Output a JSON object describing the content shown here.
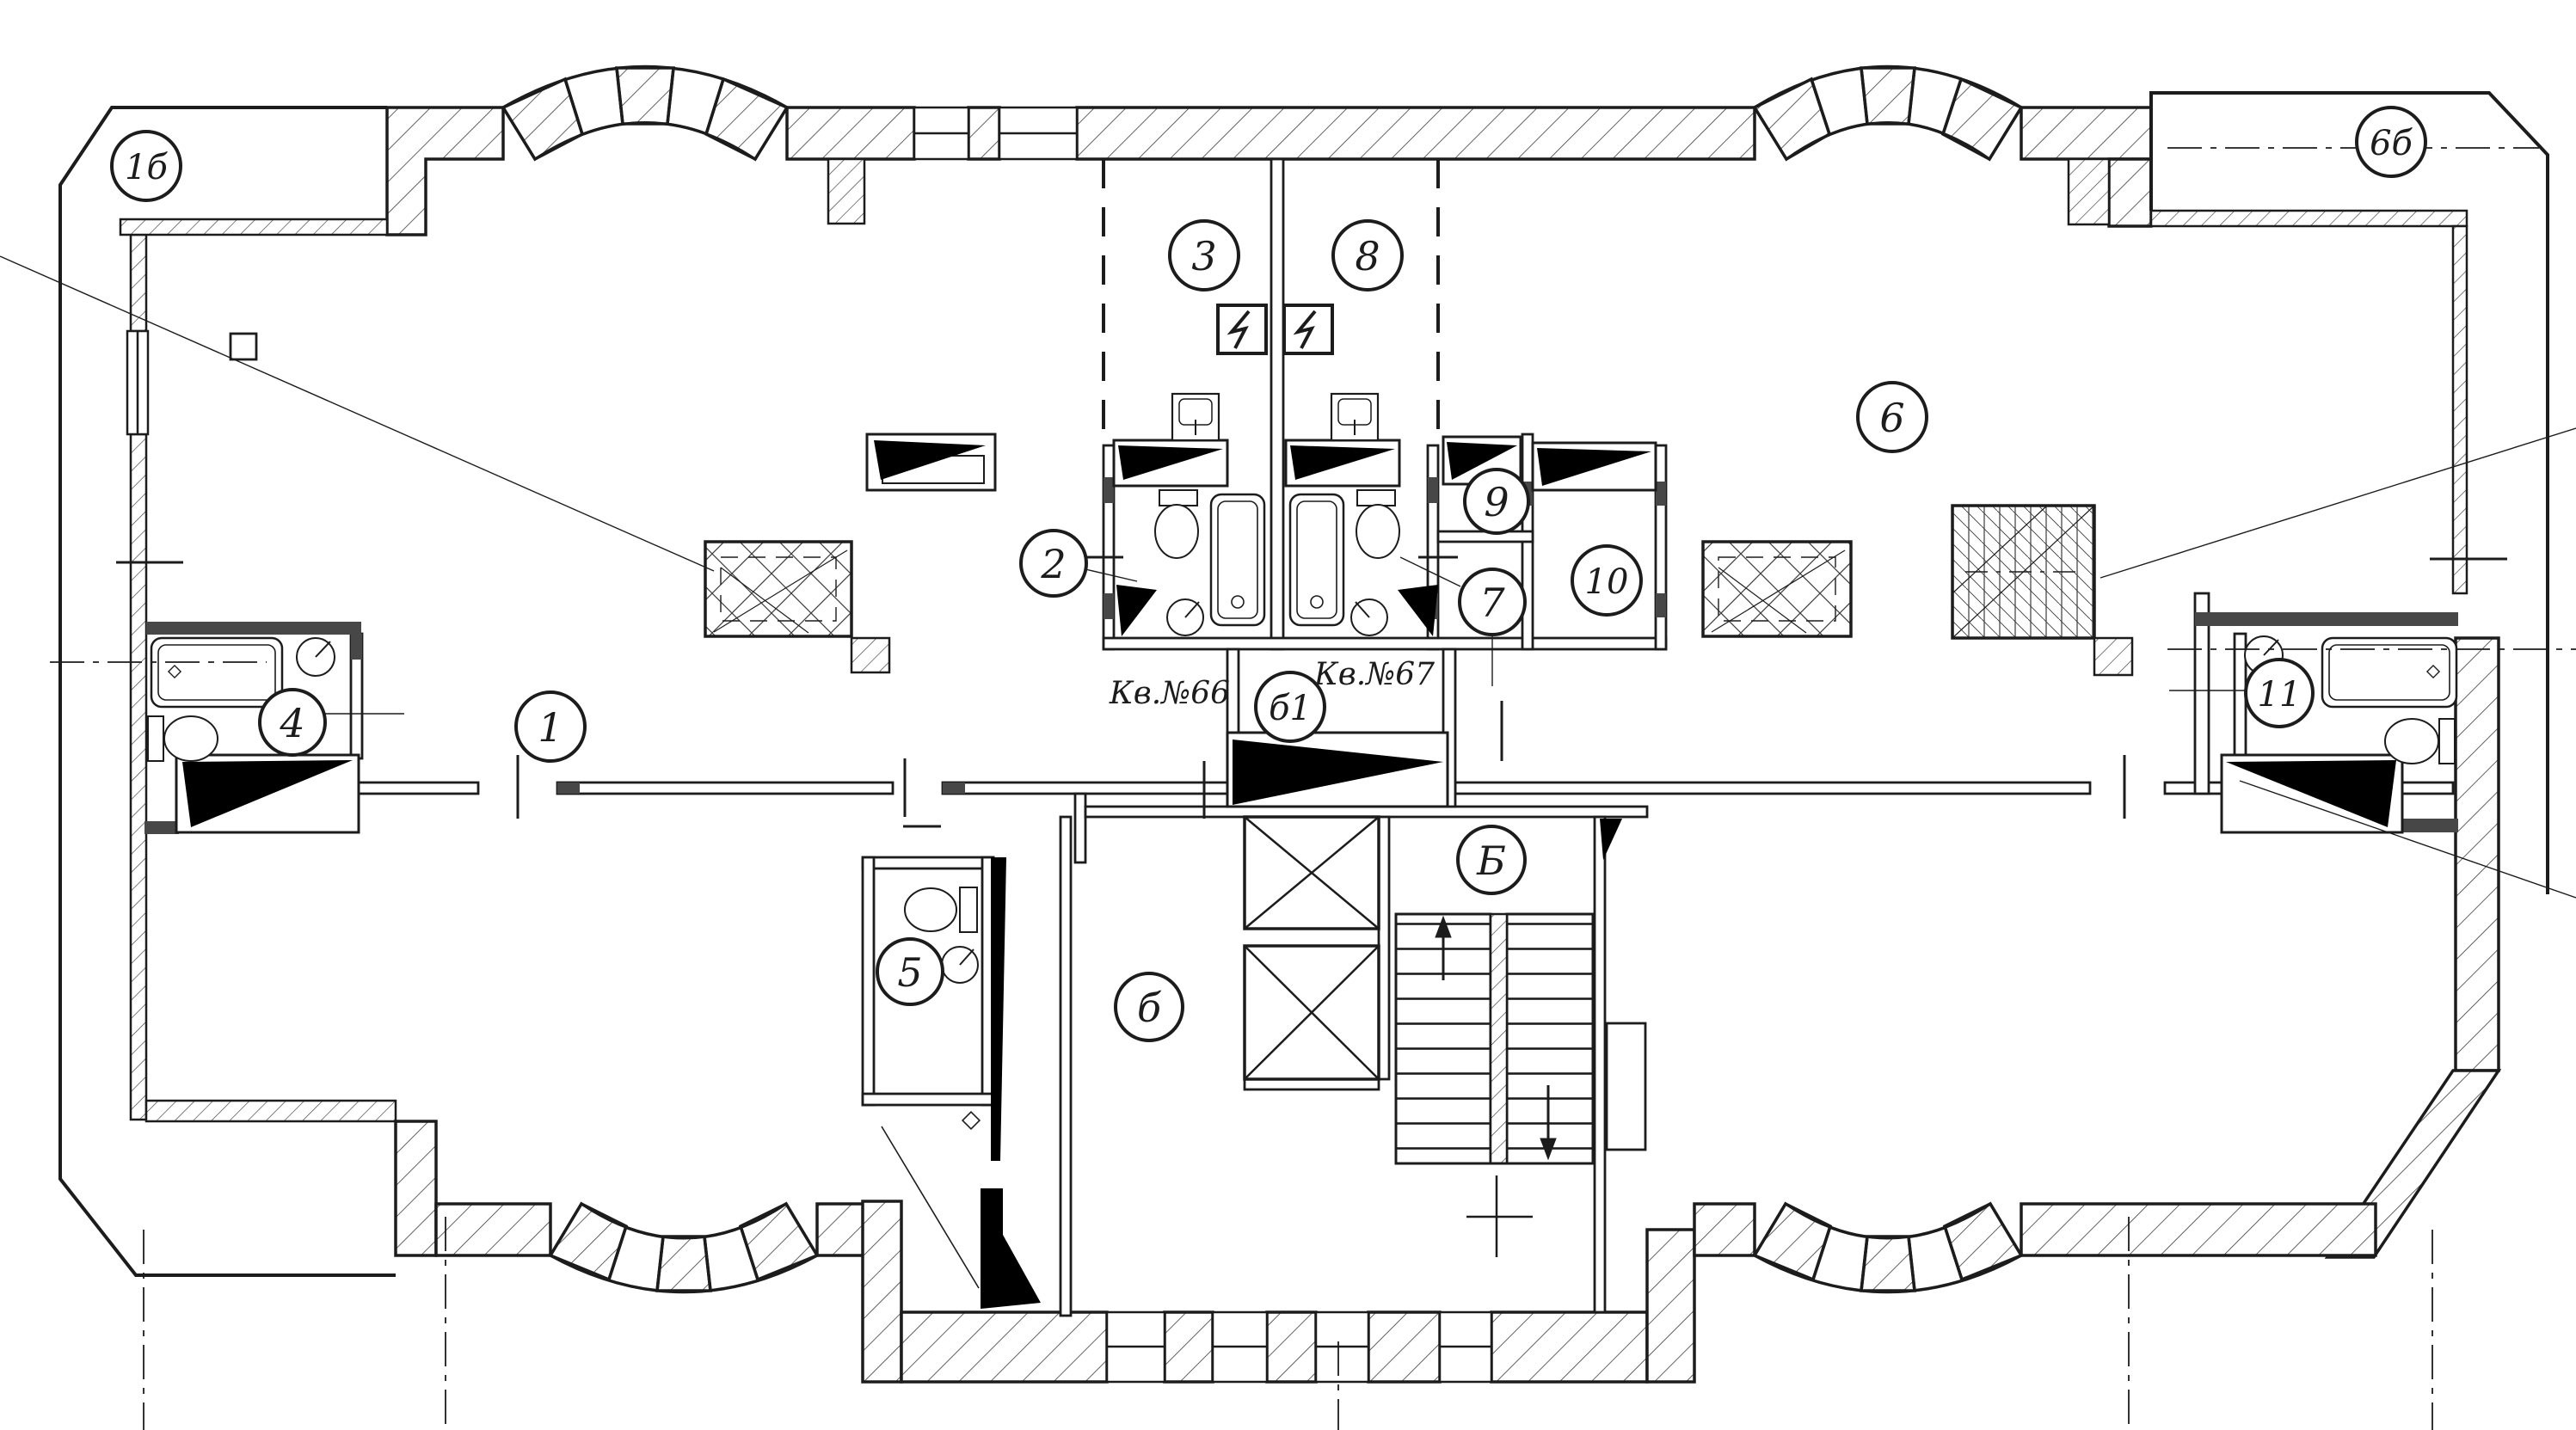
{
  "type": "architectural-floor-plan",
  "colors": {
    "ink": "#1c1c1c",
    "paper": "#ffffff",
    "wall_fill_dark": "#474747",
    "door_leaf_fill": "#000000"
  },
  "apartments": {
    "left_label": "Кв.№66",
    "right_label": "Кв.№67"
  },
  "rooms": {
    "balcony_left": {
      "label": "1б"
    },
    "room3": {
      "label": "3"
    },
    "room8": {
      "label": "8"
    },
    "room6": {
      "label": "6"
    },
    "balcony_right": {
      "label": "6б"
    },
    "room2": {
      "label": "2"
    },
    "room9": {
      "label": "9"
    },
    "room7": {
      "label": "7"
    },
    "room10": {
      "label": "10"
    },
    "room4": {
      "label": "4"
    },
    "room1": {
      "label": "1"
    },
    "room11": {
      "label": "11"
    },
    "room5": {
      "label": "5"
    },
    "vestibule": {
      "label": "б1"
    },
    "stairwell": {
      "label": "Б"
    },
    "lobby": {
      "label": "б"
    }
  }
}
